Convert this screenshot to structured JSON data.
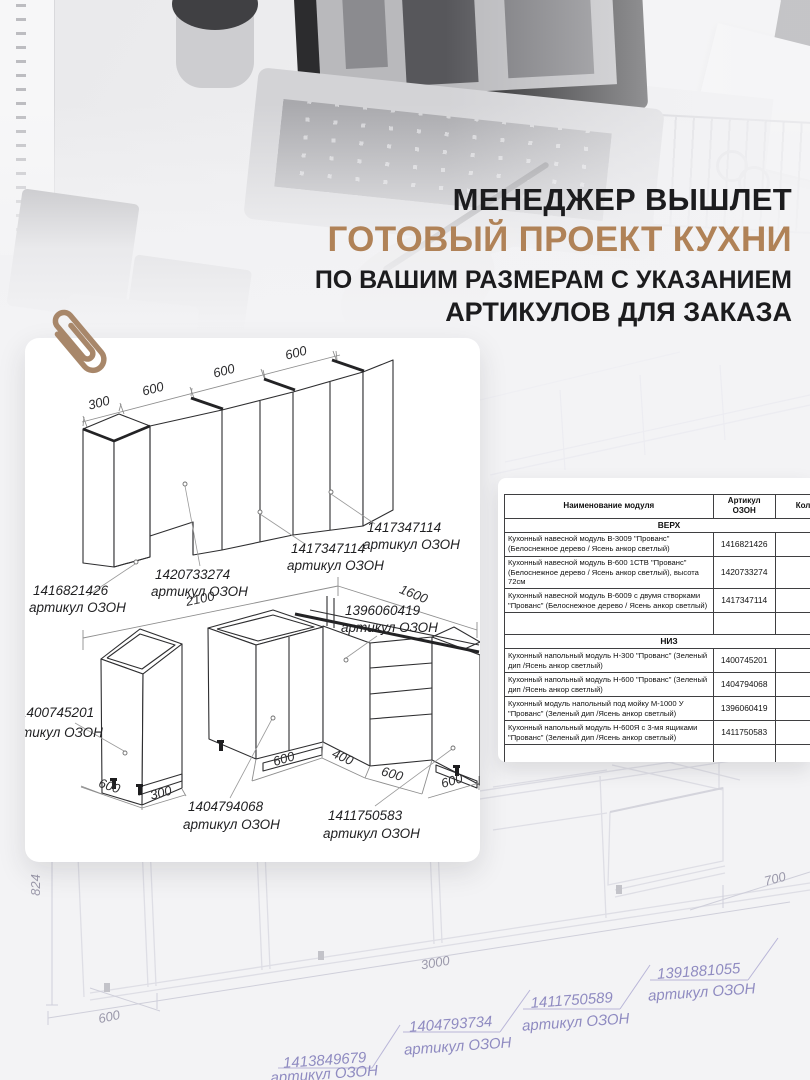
{
  "header": {
    "line1": "МЕНЕДЖЕР ВЫШЛЕТ",
    "line2": "ГОТОВЫЙ ПРОЕКТ КУХНИ",
    "line3": "ПО ВАШИМ РАЗМЕРАМ С УКАЗАНИЕМ",
    "line4": "АРТИКУЛОВ ДЛЯ ЗАКАЗА",
    "accent_color": "#b08257"
  },
  "top_drawing": {
    "dim_300": "300",
    "dim_600a": "600",
    "dim_600b": "600",
    "dim_600c": "600",
    "callout1_num": "1416821426",
    "callout1_label": "артикул ОЗОН",
    "callout2_num": "1420733274",
    "callout2_label": "артикул ОЗОН",
    "callout3_num": "1417347114",
    "callout3_label": "артикул ОЗОН",
    "callout4_num": "1417347114",
    "callout4_label": "артикул ОЗОН"
  },
  "bottom_drawing": {
    "dim_2100": "2100",
    "dim_1600": "1600",
    "dim_600_left": "600",
    "dim_300_left": "300",
    "dim_600_a": "600",
    "dim_400": "400",
    "dim_600_b": "600",
    "dim_600_c": "600",
    "callout_n300_num": "1400745201",
    "callout_n300_label": "тикул ОЗОН",
    "callout_corner_num": "1396060419",
    "callout_corner_label": "артикул ОЗОН",
    "callout_sink_num": "1404794068",
    "callout_sink_label": "артикул ОЗОН",
    "callout_drawer_num": "1411750583",
    "callout_drawer_label": "артикул ОЗОН"
  },
  "table": {
    "col_name": "Наименование модуля",
    "col_article": "Артикул ОЗОН",
    "col_qty": "Кол-",
    "section_top": "ВЕРХ",
    "section_bottom": "НИЗ",
    "rows_top": [
      {
        "name": "Кухонный навесной модуль В-3009 \"Прованс\" (Белоснежное дерево / Ясень анкор светлый)",
        "article": "1416821426"
      },
      {
        "name": "Кухонный навесной модуль В-600 1СТВ \"Прованс\" (Белоснежное дерево / Ясень анкор светлый), высота 72см",
        "article": "1420733274"
      },
      {
        "name": "Кухонный навесной модуль В-6009 с двумя створками \"Прованс\" (Белоснежное дерево / Ясень анкор светлый)",
        "article": "1417347114"
      }
    ],
    "rows_bottom": [
      {
        "name": "Кухонный напольный модуль Н-300 \"Прованс\" (Зеленый дип /Ясень анкор светлый)",
        "article": "1400745201"
      },
      {
        "name": "Кухонный напольный модуль Н-600 \"Прованс\" (Зеленый дип /Ясень анкор светлый)",
        "article": "1404794068"
      },
      {
        "name": "Кухонный модуль напольный под мойку М-1000 У \"Прованс\" (Зеленый дип /Ясень анкор светлый)",
        "article": "1396060419"
      },
      {
        "name": "Кухонный напольный модуль Н-600Я с 3-мя ящиками \"Прованс\" (Зеленый дип /Ясень анкор светлый)",
        "article": "1411750583"
      }
    ]
  },
  "background_drawing": {
    "dim_824": "824",
    "dim_600": "600",
    "dim_3000": "3000",
    "dim_700": "700",
    "callout1_num": "1413849679",
    "callout1_label": "артикул ОЗОН",
    "callout2_num": "1404793734",
    "callout2_label": "артикул ОЗОН",
    "callout3_num": "1411750589",
    "callout3_label": "артикул ОЗОН",
    "callout4_num": "1391881055",
    "callout4_label": "артикул ОЗОН"
  }
}
